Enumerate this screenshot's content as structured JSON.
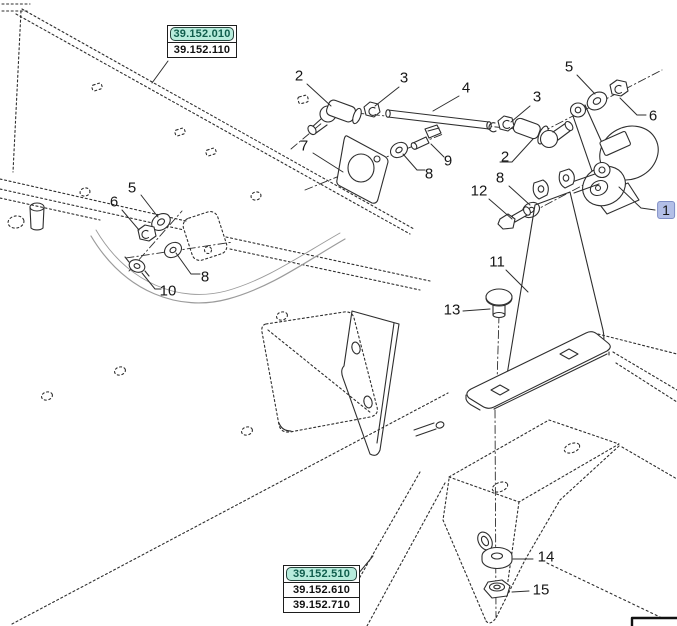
{
  "ref_boxes": {
    "top": [
      {
        "label": "39.152.010",
        "highlighted": true
      },
      {
        "label": "39.152.110",
        "highlighted": false
      }
    ],
    "bottom": [
      {
        "label": "39.152.510",
        "highlighted": true
      },
      {
        "label": "39.152.610",
        "highlighted": false
      },
      {
        "label": "39.152.710",
        "highlighted": false
      }
    ]
  },
  "callouts": {
    "n1": "1",
    "n2_left": "2",
    "n2_right": "2",
    "n3_left": "3",
    "n3_right": "3",
    "n4": "4",
    "n5_left": "5",
    "n5_right": "5",
    "n6_left": "6",
    "n6_right": "6",
    "n7": "7",
    "n8_left": "8",
    "n8_mid": "8",
    "n8_right": "8",
    "n9": "9",
    "n10": "10",
    "n11": "11",
    "n12": "12",
    "n13": "13",
    "n14": "14",
    "n15": "15"
  },
  "colors": {
    "highlight_teal": "#b7ecdc",
    "highlight_teal_text": "#115e4d",
    "highlight_blue": "#b3bfe7",
    "line": "#2e2e2e"
  }
}
